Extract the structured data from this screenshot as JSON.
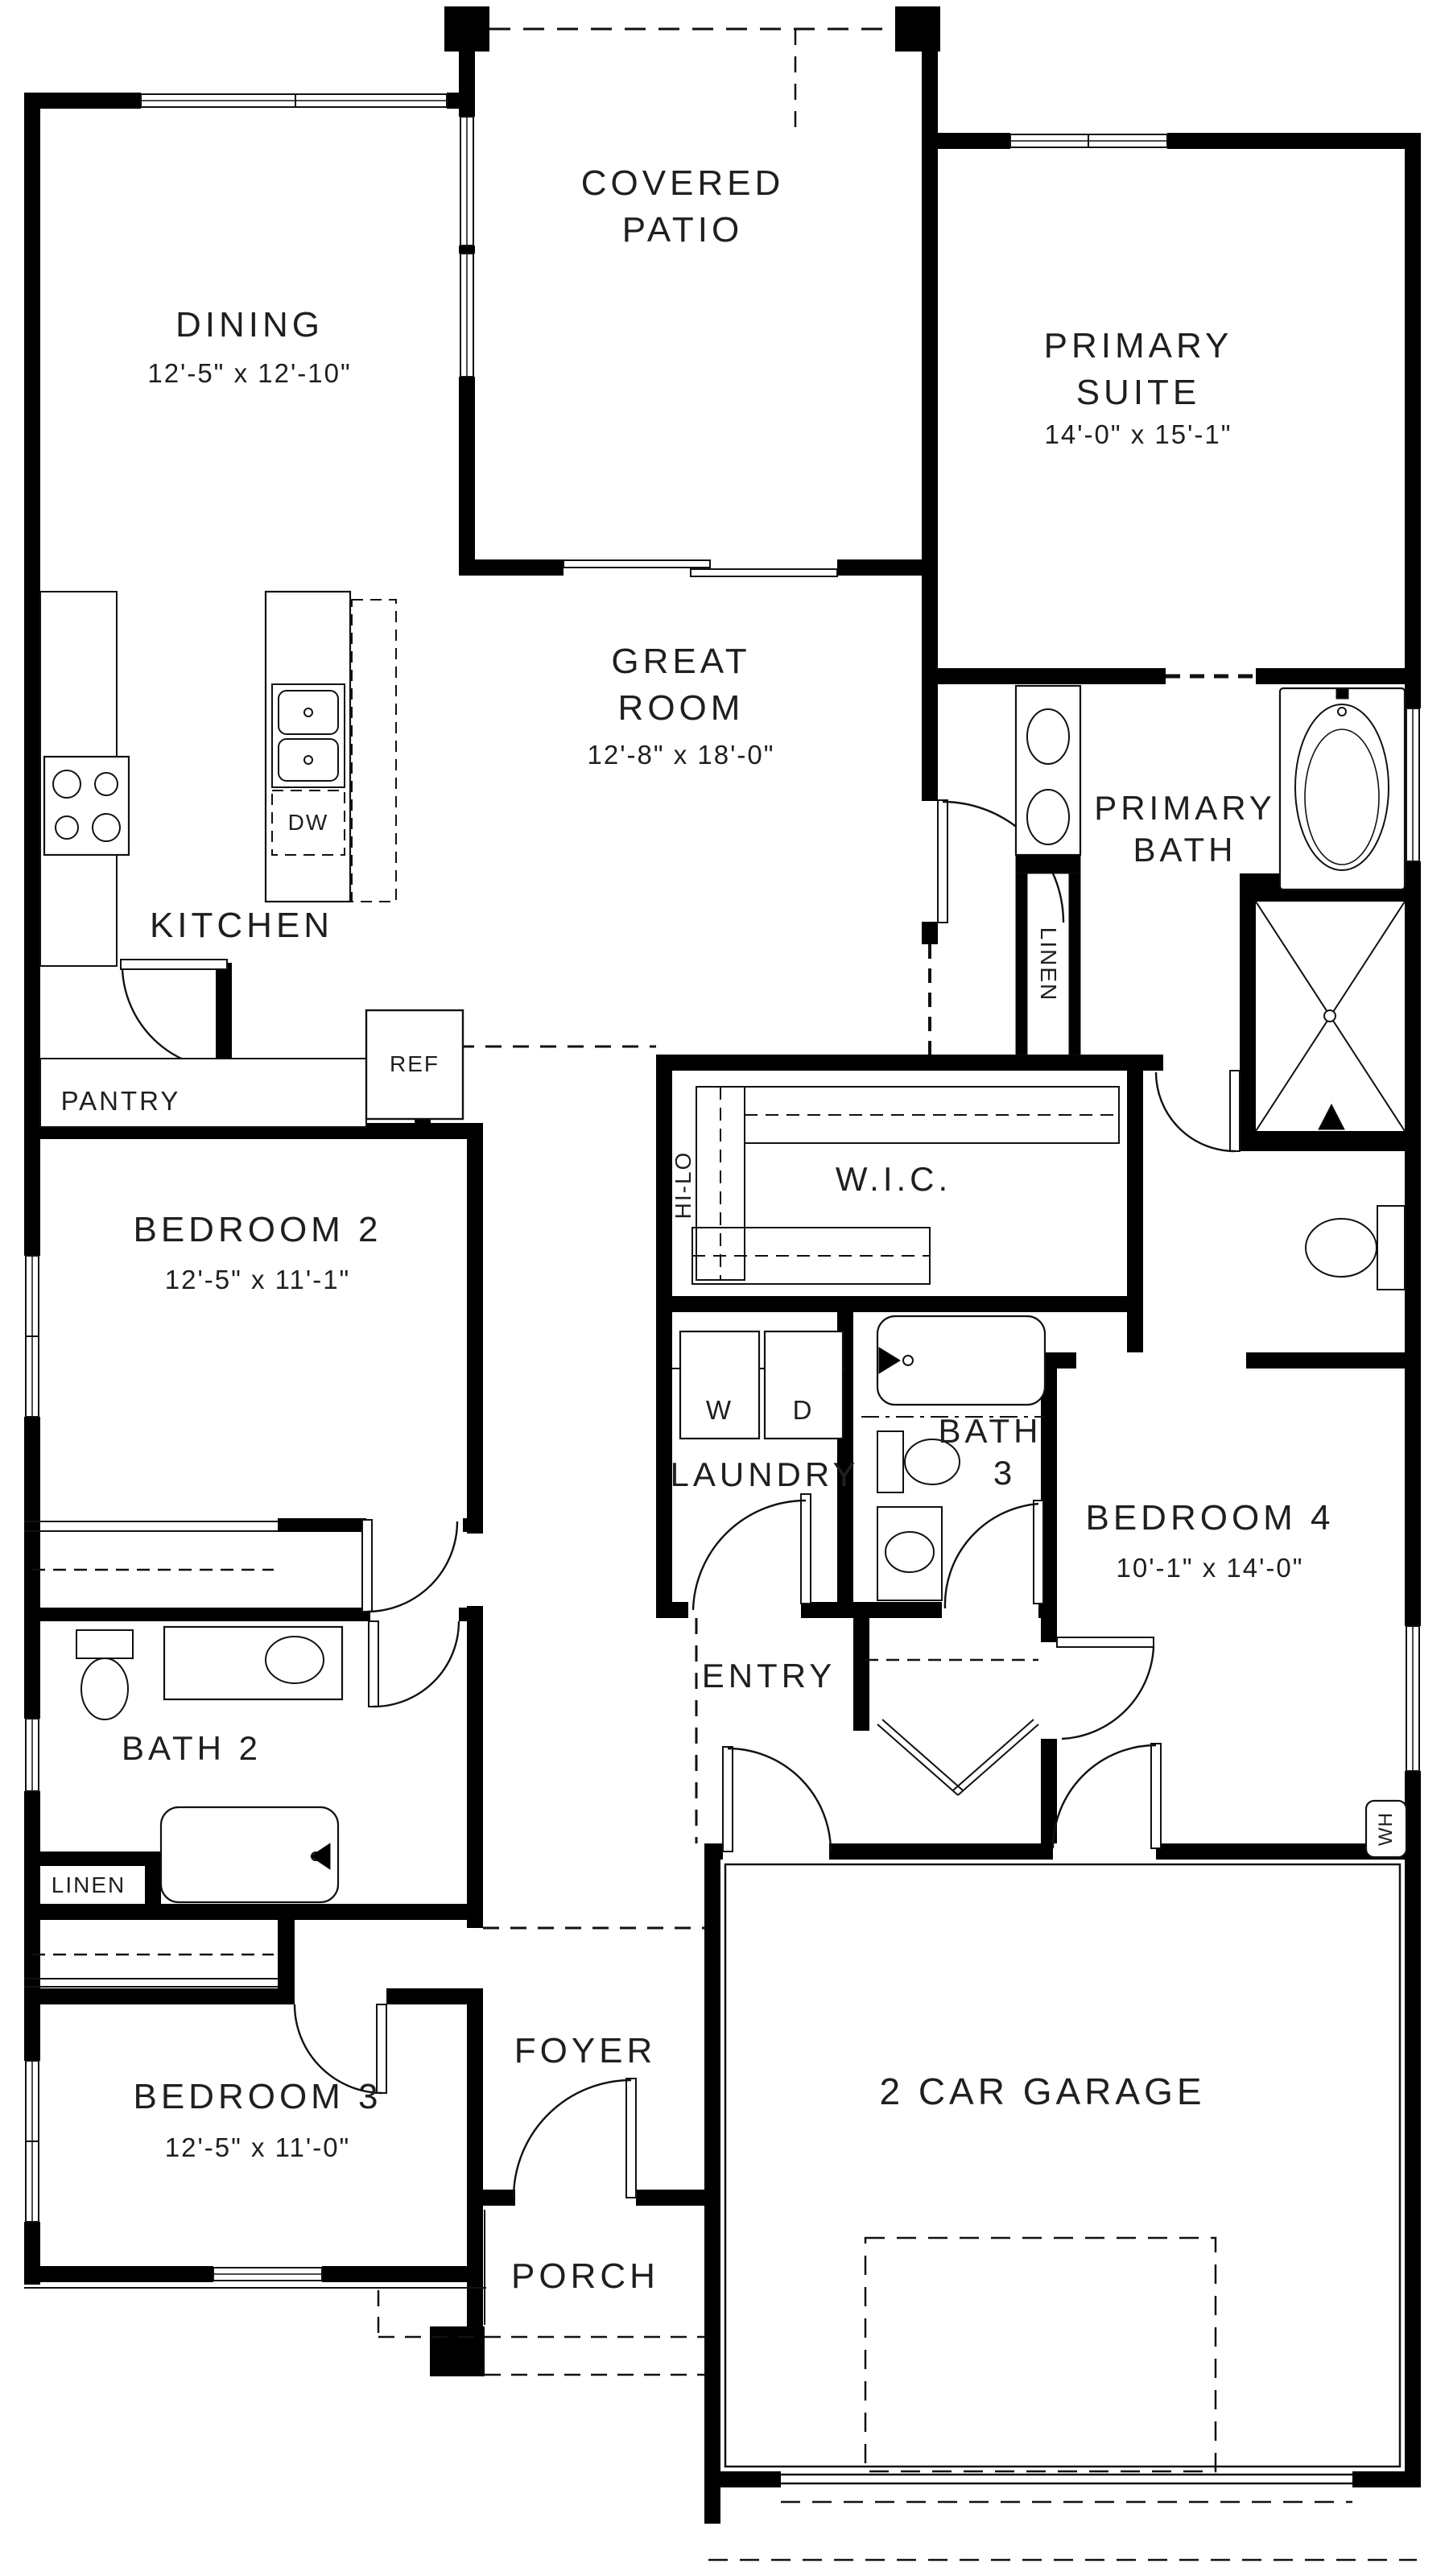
{
  "rooms": {
    "covered_patio": {
      "line1": "COVERED",
      "line2": "PATIO"
    },
    "dining": {
      "name": "DINING",
      "dims": "12'-5\" x 12'-10\""
    },
    "primary_suite": {
      "line1": "PRIMARY",
      "line2": "SUITE",
      "dims": "14'-0\" x 15'-1\""
    },
    "great_room": {
      "line1": "GREAT",
      "line2": "ROOM",
      "dims": "12'-8\" x 18'-0\""
    },
    "kitchen": {
      "name": "KITCHEN"
    },
    "pantry": {
      "name": "PANTRY"
    },
    "primary_bath": {
      "line1": "PRIMARY",
      "line2": "BATH"
    },
    "wic": {
      "name": "W.I.C."
    },
    "bedroom2": {
      "name": "BEDROOM 2",
      "dims": "12'-5\" x 11'-1\""
    },
    "laundry": {
      "name": "LAUNDRY"
    },
    "bath3": {
      "line1": "BATH",
      "line2": "3"
    },
    "bedroom4": {
      "name": "BEDROOM 4",
      "dims": "10'-1\" x 14'-0\""
    },
    "entry": {
      "name": "ENTRY"
    },
    "bath2": {
      "name": "BATH 2"
    },
    "foyer": {
      "name": "FOYER"
    },
    "bedroom3": {
      "name": "BEDROOM 3",
      "dims": "12'-5\" x 11'-0\""
    },
    "garage": {
      "name": "2 CAR GARAGE"
    },
    "porch": {
      "name": "PORCH"
    }
  },
  "labels": {
    "ref": "REF",
    "dw": "DW",
    "washer": "W",
    "dryer": "D",
    "linen_primary": "LINEN",
    "linen_hall": "LINEN",
    "hi_lo": "HI-LO",
    "water_heater": "WH"
  },
  "colors": {
    "walls": "#000000",
    "lines": "#111111",
    "background": "#ffffff"
  }
}
